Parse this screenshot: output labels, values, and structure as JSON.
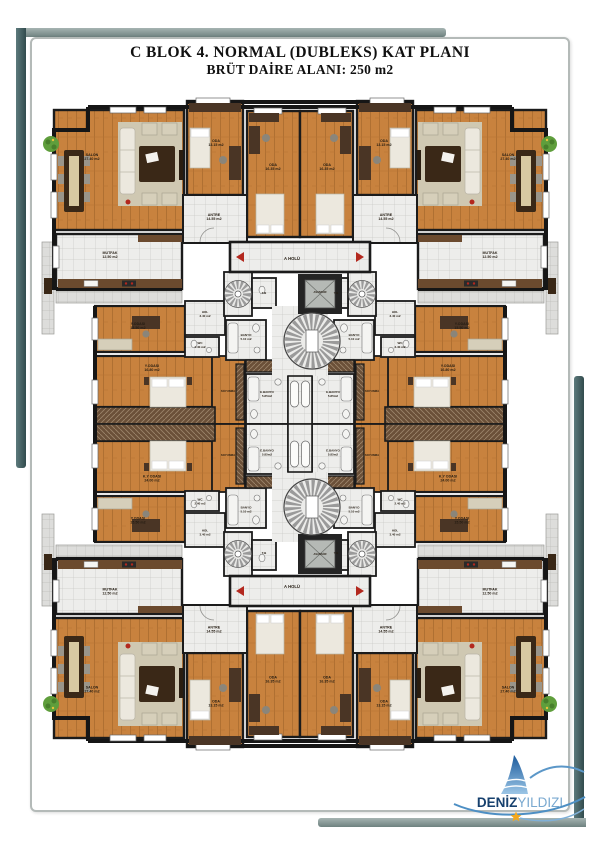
{
  "page": {
    "title_line1": "C BLOK 4. NORMAL (DUBLEKS) KAT PLANI",
    "title_line2": "BRÜT DAİRE ALANI: 250 m2"
  },
  "logo": {
    "brand_bold": "DENİZ",
    "brand_light": "YILDIZI",
    "colors": {
      "navy": "#16406e",
      "light_blue": "#7aa9d0",
      "sail_dark": "#1a5a9c",
      "sail_light": "#9cc6e6",
      "swoosh": "#4d8fc4",
      "star": "#f4a81d"
    }
  },
  "plan": {
    "colors": {
      "wood": "#c8823e",
      "wood_line": "#a96b2e",
      "tile": "#ededeb",
      "tile_line": "#c9c9c6",
      "balcony": "#dddddb",
      "wall": "#1b1b1b",
      "furniture_dark": "#3a2817",
      "furniture_light": "#ece8de",
      "rug": "#cfc8b2",
      "hatch": "#6b5038",
      "accent_red": "#b3281e",
      "plant_green": "#5f9e3c"
    },
    "labels": [
      {
        "t": "SALON",
        "a": "27.40 m2",
        "x": 52,
        "y": 62,
        "q": [
          0,
          1,
          2,
          3
        ]
      },
      {
        "t": "ODA",
        "a": "13.15 m2",
        "x": 176,
        "y": 48,
        "q": [
          0,
          1,
          2,
          3
        ]
      },
      {
        "t": "ODA",
        "a": "16.35 m2",
        "x": 233,
        "y": 72,
        "q": [
          0,
          1,
          2,
          3
        ]
      },
      {
        "t": "ANTRE",
        "a": "14.55 m2",
        "x": 174,
        "y": 122,
        "q": [
          0,
          1,
          2,
          3
        ]
      },
      {
        "t": "MUTFAK",
        "a": "12.50 m2",
        "x": 70,
        "y": 160,
        "q": [
          0,
          1,
          2,
          3
        ]
      },
      {
        "t": "HOL",
        "a": "3.40 m2",
        "x": 165,
        "y": 219,
        "q": [
          0,
          1,
          2,
          3
        ],
        "fs": 3
      },
      {
        "t": "WC",
        "a": "2.40 m2",
        "x": 160,
        "y": 250,
        "q": [
          0,
          1,
          2,
          3
        ],
        "fs": 3
      },
      {
        "t": "BANYO",
        "a": "5.10 m2",
        "x": 206,
        "y": 242,
        "q": [
          0,
          1,
          2,
          3
        ],
        "fs": 3
      },
      {
        "t": "T.B",
        "x": 224,
        "y": 200,
        "q": [
          0,
          1,
          2,
          3
        ],
        "fs": 3
      },
      {
        "t": "Y.ODASI",
        "a": "15.50 m2",
        "x": 98,
        "y": 231,
        "q": [
          0,
          1,
          2,
          3
        ]
      },
      {
        "t": "Y.ODASI",
        "a": "16.80 m2",
        "x": 112,
        "y": 273,
        "q": [
          0,
          1
        ]
      },
      {
        "t": "K.Y ODASI",
        "a": "24.00 m2",
        "x": 112,
        "y": 273,
        "q": [
          2,
          3
        ]
      },
      {
        "t": "SOYUNMA",
        "x": 188,
        "y": 298,
        "q": [
          0,
          1,
          2,
          3
        ],
        "fs": 2.8
      },
      {
        "t": "E.BANYO",
        "a": "5.85m2",
        "x": 227,
        "y": 299,
        "q": [
          0,
          1,
          2,
          3
        ],
        "fs": 3
      },
      {
        "t": "A HOLÜ",
        "x": 252,
        "y": 166,
        "q": [
          0,
          2
        ],
        "fs": 4.2
      },
      {
        "t": "ASANSÖR",
        "x": 280,
        "y": 199,
        "q": [
          0,
          2
        ],
        "fs": 2.6
      }
    ]
  }
}
